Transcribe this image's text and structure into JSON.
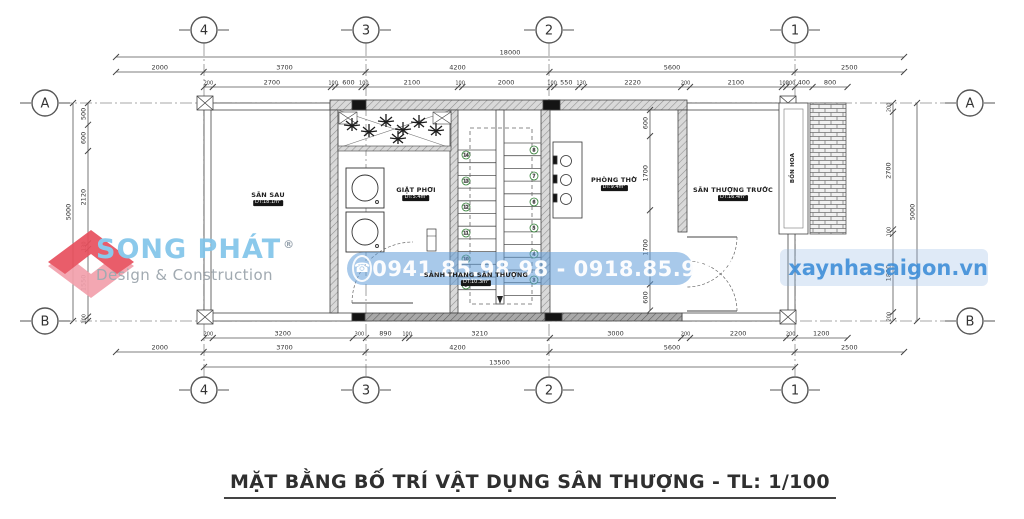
{
  "title": {
    "text": "MẶT BẰNG BỐ TRÍ VẬT DỤNG SÂN THƯỢNG - TL: 1/100"
  },
  "watermarks": {
    "logo": {
      "name": "SONG PHÁT",
      "registered": "®",
      "tagline": "Design & Construction"
    },
    "phone": {
      "text": "0941.85.98.98 - 0918.85.98.98"
    },
    "website": {
      "text": "xaynhasaigon.vn"
    }
  },
  "colors": {
    "line": "#3a3a3a",
    "dim_text": "#333333",
    "logo_blue": "#82c5ea",
    "logo_red": "#e8505e",
    "logo_pink": "#f2a0ac",
    "tagline_gray": "#9aa3ab",
    "phone_band_blue": "rgba(96,156,216,0.55)",
    "site_blue": "#3f8fd8",
    "step_green": "#2e7d32"
  },
  "grid": {
    "columns": [
      {
        "label": "4",
        "x": 204
      },
      {
        "label": "3",
        "x": 366
      },
      {
        "label": "2",
        "x": 549
      },
      {
        "label": "1",
        "x": 795
      }
    ],
    "rows": [
      {
        "label": "A",
        "y": 103
      },
      {
        "label": "B",
        "y": 321
      }
    ],
    "bubble": {
      "top_y": 30,
      "bottom_y": 390,
      "left_x": 45,
      "right_x": 970,
      "radius": 13
    }
  },
  "rooms": [
    {
      "name": "SÂN SAU",
      "tag": "DT:18.1m²",
      "x": 268,
      "y": 199,
      "vertical": false
    },
    {
      "name": "GIẶT PHƠI",
      "tag": "DT:5.4m²",
      "x": 416,
      "y": 194,
      "vertical": false
    },
    {
      "name": "SẢNH THANG SÂN THƯỢNG",
      "tag": "DT:10.3m²",
      "x": 476,
      "y": 279,
      "vertical": false
    },
    {
      "name": "PHÒNG THỜ",
      "tag": "DT:9.4m²",
      "x": 614,
      "y": 184,
      "vertical": false
    },
    {
      "name": "SÂN THƯỢNG TRƯỚC",
      "tag": "DT:16.4m²",
      "x": 733,
      "y": 194,
      "vertical": false
    },
    {
      "name": "BỒN HOA",
      "tag": "",
      "x": 793,
      "y": 168,
      "vertical": true
    }
  ],
  "stair": {
    "left_steps": [
      "14",
      "13",
      "12",
      "11",
      "10",
      "9"
    ],
    "right_steps": [
      "8",
      "7",
      "6",
      "5",
      "4",
      "3"
    ]
  },
  "dimensions": {
    "scale_h": 0.04378,
    "scale_v": 0.0436,
    "chains": [
      {
        "id": "top-overall",
        "orient": "h",
        "x": 116,
        "y": 57,
        "values": [
          18000
        ]
      },
      {
        "id": "top-grid",
        "orient": "h",
        "x": 116,
        "y": 72,
        "values": [
          2000,
          3700,
          4200,
          5600,
          2500
        ]
      },
      {
        "id": "top-detail",
        "orient": "h",
        "x": 204,
        "y": 87,
        "values": [
          200,
          2700,
          100,
          600,
          100,
          2100,
          100,
          2000,
          100,
          550,
          130,
          2220,
          200,
          2100,
          100,
          200,
          400,
          800
        ]
      },
      {
        "id": "bottom-detail",
        "orient": "h",
        "x": 204,
        "y": 338,
        "values": [
          200,
          3200,
          300,
          890,
          100,
          3210,
          3000,
          200,
          2200,
          200,
          1200
        ]
      },
      {
        "id": "bottom-grid",
        "orient": "h",
        "x": 116,
        "y": 352,
        "values": [
          2000,
          3700,
          4200,
          5600,
          2500
        ]
      },
      {
        "id": "bottom-overall",
        "orient": "h",
        "x": 204,
        "y": 367,
        "values": [
          13500
        ]
      },
      {
        "id": "left-overall",
        "orient": "v",
        "x": 73,
        "y": 103,
        "values": [
          5000
        ]
      },
      {
        "id": "left-detail",
        "orient": "v",
        "x": 88,
        "y": 103,
        "values": [
          500,
          600,
          2120,
          130,
          1550,
          100
        ]
      },
      {
        "id": "interior-vertical",
        "orient": "v",
        "x": 650,
        "y": 110,
        "values": [
          600,
          1700,
          1700,
          600
        ]
      },
      {
        "id": "right-detail",
        "orient": "v",
        "x": 893,
        "y": 103,
        "values": [
          200,
          2700,
          100,
          1800,
          200
        ]
      },
      {
        "id": "right-overall",
        "orient": "v",
        "x": 917,
        "y": 103,
        "values": [
          5000
        ]
      }
    ]
  }
}
